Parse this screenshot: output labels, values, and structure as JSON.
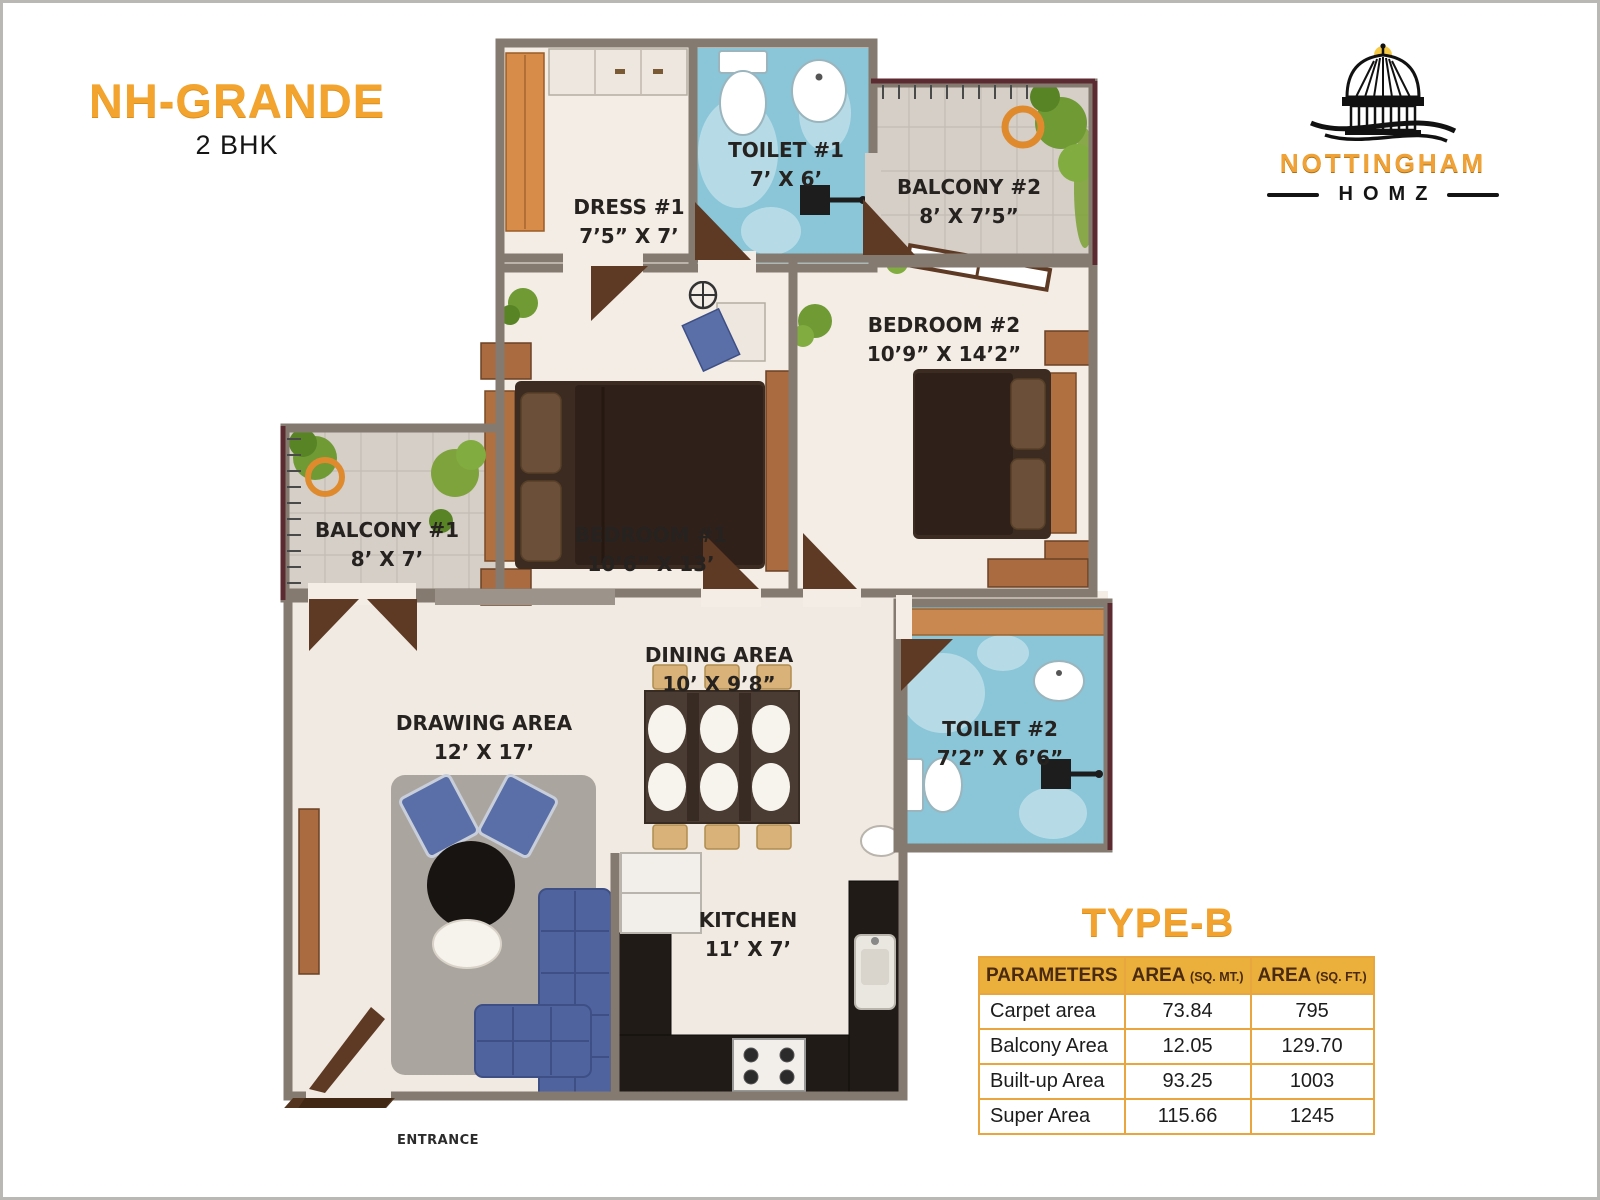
{
  "header": {
    "title": "NH-GRANDE",
    "subtitle": "2 BHK"
  },
  "logo": {
    "brand": "NOTTINGHAM",
    "sub": "HOMZ",
    "icon": "capitol-dome-icon"
  },
  "floorplan": {
    "rooms": [
      {
        "id": "dress-1",
        "label": "DRESS #1",
        "dims": "7’5” X 7’"
      },
      {
        "id": "toilet-1",
        "label": "TOILET #1",
        "dims": "7’ X 6’"
      },
      {
        "id": "balcony-2",
        "label": "BALCONY #2",
        "dims": "8’ X 7’5”"
      },
      {
        "id": "bedroom-2",
        "label": "BEDROOM #2",
        "dims": "10’9” X 14’2”"
      },
      {
        "id": "bedroom-1",
        "label": "BEDROOM #1",
        "dims": "10’6” X 13’"
      },
      {
        "id": "balcony-1",
        "label": "BALCONY #1",
        "dims": "8’ X 7’"
      },
      {
        "id": "drawing",
        "label": "DRAWING  AREA",
        "dims": "12’ X 17’"
      },
      {
        "id": "dining",
        "label": "DINING  AREA",
        "dims": "10’ X 9’8”"
      },
      {
        "id": "toilet-2",
        "label": "TOILET #2",
        "dims": "7’2” X 6’6”"
      },
      {
        "id": "kitchen",
        "label": "KITCHEN",
        "dims": "11’ X 7’"
      }
    ],
    "entrance_label": "ENTRANCE"
  },
  "area_table": {
    "title": "TYPE-B",
    "header": {
      "parameters": "PARAMETERS",
      "mt": {
        "main": "AREA",
        "sub": "(SQ. MT.)"
      },
      "ft": {
        "main": "AREA",
        "sub": "(SQ. FT.)"
      }
    },
    "rows": [
      {
        "parameter": "Carpet area",
        "sq_mt": "73.84",
        "sq_ft": "795"
      },
      {
        "parameter": "Balcony Area",
        "sq_mt": "12.05",
        "sq_ft": "129.70"
      },
      {
        "parameter": "Built-up Area",
        "sq_mt": "93.25",
        "sq_ft": "1003"
      },
      {
        "parameter": "Super Area",
        "sq_mt": "115.66",
        "sq_ft": "1245"
      }
    ]
  },
  "colors": {
    "accent_orange": "#F3A42E",
    "table_header_bg": "#EBAF3B",
    "table_border": "#E9A63F",
    "wall_gray": "#847A70",
    "toilet_blue": "#8AC6D8",
    "balcony_gray": "#D5CFC8",
    "floor_cream": "#F3EDE5",
    "wood_brown": "#5E3A24",
    "sofa_blue": "#4F639F"
  }
}
